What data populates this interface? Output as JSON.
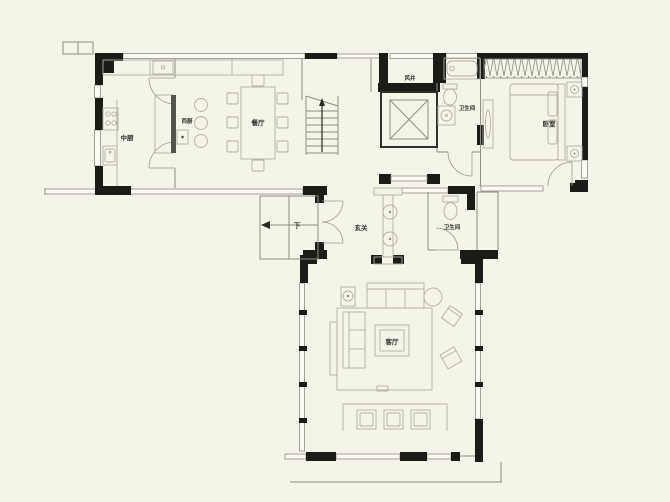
{
  "colors": {
    "background": "#f5f4e9",
    "wall": "#1c1c16",
    "thin_line": "#8d8d81",
    "furniture_line": "#b2b0a3",
    "label": "#2f2f27",
    "island_accent": "#54544a"
  },
  "rooms": [
    {
      "id": "kitchen",
      "label": "中厨"
    },
    {
      "id": "west_kitchen",
      "label": "西厨"
    },
    {
      "id": "dining",
      "label": "餐厅"
    },
    {
      "id": "air_shaft",
      "label": "风井"
    },
    {
      "id": "bath_upper",
      "label": "卫生间"
    },
    {
      "id": "bedroom",
      "label": "卧室"
    },
    {
      "id": "foyer",
      "label": "玄关"
    },
    {
      "id": "bath_mid",
      "label": "卫生间"
    },
    {
      "id": "stair_down",
      "label": "下"
    },
    {
      "id": "living",
      "label": "客厅"
    }
  ]
}
